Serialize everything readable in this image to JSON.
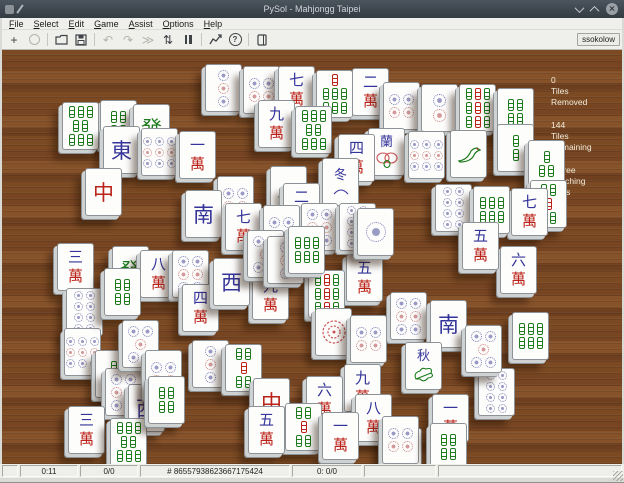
{
  "window": {
    "title": "PySol - Mahjongg Taipei",
    "controls": [
      {
        "name": "minimize-icon"
      },
      {
        "name": "maximize-icon"
      },
      {
        "name": "close-icon"
      }
    ]
  },
  "menu": {
    "items": [
      {
        "label": "File"
      },
      {
        "label": "Select"
      },
      {
        "label": "Edit"
      },
      {
        "label": "Game"
      },
      {
        "label": "Assist"
      },
      {
        "label": "Options"
      },
      {
        "label": "Help"
      }
    ]
  },
  "toolbar": {
    "user": "ssokolow",
    "buttons": [
      {
        "name": "new-game",
        "icon": "plus",
        "enabled": true
      },
      {
        "name": "select-game",
        "icon": "circle",
        "enabled": false
      },
      {
        "sep": true
      },
      {
        "name": "open",
        "icon": "folder",
        "enabled": true
      },
      {
        "name": "save",
        "icon": "floppy",
        "enabled": true
      },
      {
        "sep": true
      },
      {
        "name": "undo",
        "icon": "undo",
        "enabled": false
      },
      {
        "name": "redo",
        "icon": "redo",
        "enabled": false
      },
      {
        "name": "autodrop",
        "icon": "fastforward",
        "enabled": false
      },
      {
        "name": "shuffle",
        "icon": "shuffle",
        "enabled": true
      },
      {
        "name": "pause",
        "icon": "pause",
        "enabled": true
      },
      {
        "sep": true
      },
      {
        "name": "statistics",
        "icon": "chart",
        "enabled": true
      },
      {
        "name": "help",
        "icon": "help",
        "enabled": true
      },
      {
        "sep": true
      },
      {
        "name": "rules",
        "icon": "book",
        "enabled": true
      }
    ]
  },
  "sidebar": {
    "stats": [
      {
        "name": "tiles-removed",
        "lines": [
          "0",
          "Tiles",
          "Removed"
        ]
      },
      {
        "name": "tiles-remaining",
        "lines": [
          "144",
          "Tiles",
          "Remaining"
        ]
      },
      {
        "name": "free-matching-pairs",
        "lines": [
          "4 Free",
          "Matching",
          "Pairs"
        ]
      }
    ]
  },
  "statusbar": {
    "segments": [
      {
        "name": "status-spacer",
        "text": "",
        "width": 16
      },
      {
        "name": "status-time",
        "text": "0:11",
        "width": 58
      },
      {
        "name": "status-moves",
        "text": "0/0",
        "width": 58
      },
      {
        "name": "status-game-number",
        "text": "# 86557938623667175424",
        "width": 150
      },
      {
        "name": "status-stacks",
        "text": "0: 0/0",
        "width": 70
      },
      {
        "name": "status-extra",
        "text": "",
        "width": 72
      },
      {
        "name": "status-message",
        "text": "",
        "width": 0
      }
    ]
  },
  "board": {
    "tiles": [
      {
        "x": 205,
        "y": 64,
        "z": 1,
        "k": "d",
        "v": 3
      },
      {
        "x": 243,
        "y": 66,
        "z": 1,
        "k": "d",
        "v": 4
      },
      {
        "x": 278,
        "y": 66,
        "z": 1,
        "k": "w",
        "v": "七"
      },
      {
        "x": 316,
        "y": 70,
        "z": 1,
        "k": "b",
        "v": 7
      },
      {
        "x": 352,
        "y": 68,
        "z": 1,
        "k": "w",
        "v": "二"
      },
      {
        "x": 383,
        "y": 82,
        "z": 1,
        "k": "d",
        "v": 4
      },
      {
        "x": 421,
        "y": 84,
        "z": 1,
        "k": "d",
        "v": 2
      },
      {
        "x": 459,
        "y": 84,
        "z": 1,
        "k": "b",
        "v": 9
      },
      {
        "x": 497,
        "y": 88,
        "z": 1,
        "k": "b",
        "v": 4
      },
      {
        "x": 62,
        "y": 102,
        "z": 1,
        "k": "b",
        "v": 8
      },
      {
        "x": 100,
        "y": 100,
        "z": 1,
        "k": "b",
        "v": 4
      },
      {
        "x": 133,
        "y": 104,
        "z": 1,
        "k": "drag",
        "v": "發"
      },
      {
        "x": 258,
        "y": 100,
        "z": 1,
        "k": "w",
        "v": "九"
      },
      {
        "x": 295,
        "y": 106,
        "z": 1,
        "k": "b",
        "v": 8
      },
      {
        "x": 497,
        "y": 124,
        "z": 1,
        "k": "b",
        "v": 2
      },
      {
        "x": 528,
        "y": 140,
        "z": 1,
        "k": "b",
        "v": 3
      },
      {
        "x": 530,
        "y": 180,
        "z": 1,
        "k": "b",
        "v": 5
      },
      {
        "x": 511,
        "y": 188,
        "z": 1,
        "k": "w",
        "v": "七"
      },
      {
        "x": 57,
        "y": 243,
        "z": 1,
        "k": "w",
        "v": "三"
      },
      {
        "x": 500,
        "y": 246,
        "z": 1,
        "k": "w",
        "v": "六"
      },
      {
        "x": 66,
        "y": 288,
        "z": 1,
        "k": "d",
        "v": 8
      },
      {
        "x": 512,
        "y": 312,
        "z": 1,
        "k": "b",
        "v": 6
      },
      {
        "x": 64,
        "y": 328,
        "z": 1,
        "k": "d",
        "v": 9
      },
      {
        "x": 95,
        "y": 350,
        "z": 1,
        "k": "b",
        "v": 2
      },
      {
        "x": 105,
        "y": 368,
        "z": 1,
        "k": "d",
        "v": 6
      },
      {
        "x": 128,
        "y": 384,
        "z": 1,
        "k": "wind",
        "v": "西"
      },
      {
        "x": 68,
        "y": 406,
        "z": 1,
        "k": "w",
        "v": "三"
      },
      {
        "x": 110,
        "y": 418,
        "z": 1,
        "k": "b",
        "v": 8
      },
      {
        "x": 385,
        "y": 428,
        "z": 1,
        "k": "wind",
        "v": "北"
      },
      {
        "x": 478,
        "y": 368,
        "z": 1,
        "k": "d",
        "v": 8
      },
      {
        "x": 103,
        "y": 126,
        "z": 2,
        "k": "wind",
        "v": "東"
      },
      {
        "x": 141,
        "y": 128,
        "z": 2,
        "k": "d",
        "v": 9
      },
      {
        "x": 179,
        "y": 131,
        "z": 2,
        "k": "w",
        "v": "一"
      },
      {
        "x": 338,
        "y": 134,
        "z": 2,
        "k": "w",
        "v": "四"
      },
      {
        "x": 368,
        "y": 128,
        "z": 2,
        "k": "s",
        "v": "orchid"
      },
      {
        "x": 408,
        "y": 131,
        "z": 2,
        "k": "d",
        "v": 9
      },
      {
        "x": 450,
        "y": 130,
        "z": 2,
        "k": "s",
        "v": "bird"
      },
      {
        "x": 85,
        "y": 168,
        "z": 2,
        "k": "drag",
        "v": "中"
      },
      {
        "x": 217,
        "y": 176,
        "z": 2,
        "k": "d",
        "v": 4
      },
      {
        "x": 270,
        "y": 166,
        "z": 2,
        "k": "s",
        "v": "bird"
      },
      {
        "x": 322,
        "y": 158,
        "z": 2,
        "k": "s",
        "v": "winter"
      },
      {
        "x": 283,
        "y": 183,
        "z": 2,
        "k": "w",
        "v": "二"
      },
      {
        "x": 185,
        "y": 190,
        "z": 2,
        "k": "wind",
        "v": "南"
      },
      {
        "x": 435,
        "y": 184,
        "z": 2,
        "k": "d",
        "v": 8
      },
      {
        "x": 473,
        "y": 186,
        "z": 2,
        "k": "b",
        "v": 6
      },
      {
        "x": 462,
        "y": 222,
        "z": 2,
        "k": "w",
        "v": "五"
      },
      {
        "x": 112,
        "y": 246,
        "z": 2,
        "k": "drag",
        "v": "發"
      },
      {
        "x": 140,
        "y": 250,
        "z": 2,
        "k": "w",
        "v": "八"
      },
      {
        "x": 172,
        "y": 250,
        "z": 2,
        "k": "d",
        "v": 6
      },
      {
        "x": 104,
        "y": 268,
        "z": 2,
        "k": "b",
        "v": 4
      },
      {
        "x": 122,
        "y": 320,
        "z": 2,
        "k": "d",
        "v": 5
      },
      {
        "x": 145,
        "y": 350,
        "z": 2,
        "k": "d",
        "v": 4
      },
      {
        "x": 192,
        "y": 340,
        "z": 2,
        "k": "d",
        "v": 3
      },
      {
        "x": 225,
        "y": 344,
        "z": 2,
        "k": "b",
        "v": 5
      },
      {
        "x": 148,
        "y": 376,
        "z": 2,
        "k": "b",
        "v": 4
      },
      {
        "x": 252,
        "y": 272,
        "z": 2,
        "k": "w",
        "v": "九"
      },
      {
        "x": 308,
        "y": 270,
        "z": 2,
        "k": "b",
        "v": 9
      },
      {
        "x": 346,
        "y": 254,
        "z": 2,
        "k": "w",
        "v": "五"
      },
      {
        "x": 182,
        "y": 284,
        "z": 2,
        "k": "w",
        "v": "四"
      },
      {
        "x": 315,
        "y": 308,
        "z": 2,
        "k": "s",
        "v": "mum"
      },
      {
        "x": 350,
        "y": 315,
        "z": 2,
        "k": "d",
        "v": 4
      },
      {
        "x": 390,
        "y": 292,
        "z": 2,
        "k": "d",
        "v": 6
      },
      {
        "x": 430,
        "y": 300,
        "z": 2,
        "k": "wind",
        "v": "南"
      },
      {
        "x": 465,
        "y": 325,
        "z": 2,
        "k": "d",
        "v": 5
      },
      {
        "x": 405,
        "y": 342,
        "z": 2,
        "k": "s",
        "v": "autumn"
      },
      {
        "x": 432,
        "y": 394,
        "z": 2,
        "k": "w",
        "v": "一"
      },
      {
        "x": 253,
        "y": 378,
        "z": 2,
        "k": "drag",
        "v": "中"
      },
      {
        "x": 306,
        "y": 376,
        "z": 2,
        "k": "w",
        "v": "六"
      },
      {
        "x": 344,
        "y": 364,
        "z": 2,
        "k": "w",
        "v": "九"
      },
      {
        "x": 355,
        "y": 394,
        "z": 2,
        "k": "w",
        "v": "八"
      },
      {
        "x": 248,
        "y": 406,
        "z": 2,
        "k": "w",
        "v": "五"
      },
      {
        "x": 285,
        "y": 403,
        "z": 2,
        "k": "b",
        "v": 5
      },
      {
        "x": 322,
        "y": 412,
        "z": 2,
        "k": "w",
        "v": "一"
      },
      {
        "x": 382,
        "y": 416,
        "z": 2,
        "k": "d",
        "v": 4
      },
      {
        "x": 430,
        "y": 423,
        "z": 2,
        "k": "b",
        "v": 4
      },
      {
        "x": 225,
        "y": 203,
        "z": 3,
        "k": "w",
        "v": "七"
      },
      {
        "x": 263,
        "y": 205,
        "z": 3,
        "k": "d",
        "v": 4
      },
      {
        "x": 301,
        "y": 203,
        "z": 3,
        "k": "d",
        "v": 6
      },
      {
        "x": 339,
        "y": 203,
        "z": 3,
        "k": "d",
        "v": 8
      },
      {
        "x": 357,
        "y": 208,
        "z": 3,
        "k": "d",
        "v": 1
      },
      {
        "x": 213,
        "y": 258,
        "z": 3,
        "k": "wind",
        "v": "西"
      },
      {
        "x": 247,
        "y": 230,
        "z": 4,
        "k": "d",
        "v": 5
      },
      {
        "x": 267,
        "y": 236,
        "z": 4,
        "k": "d",
        "v": 3
      },
      {
        "x": 288,
        "y": 226,
        "z": 5,
        "k": "b",
        "v": 6
      }
    ]
  }
}
